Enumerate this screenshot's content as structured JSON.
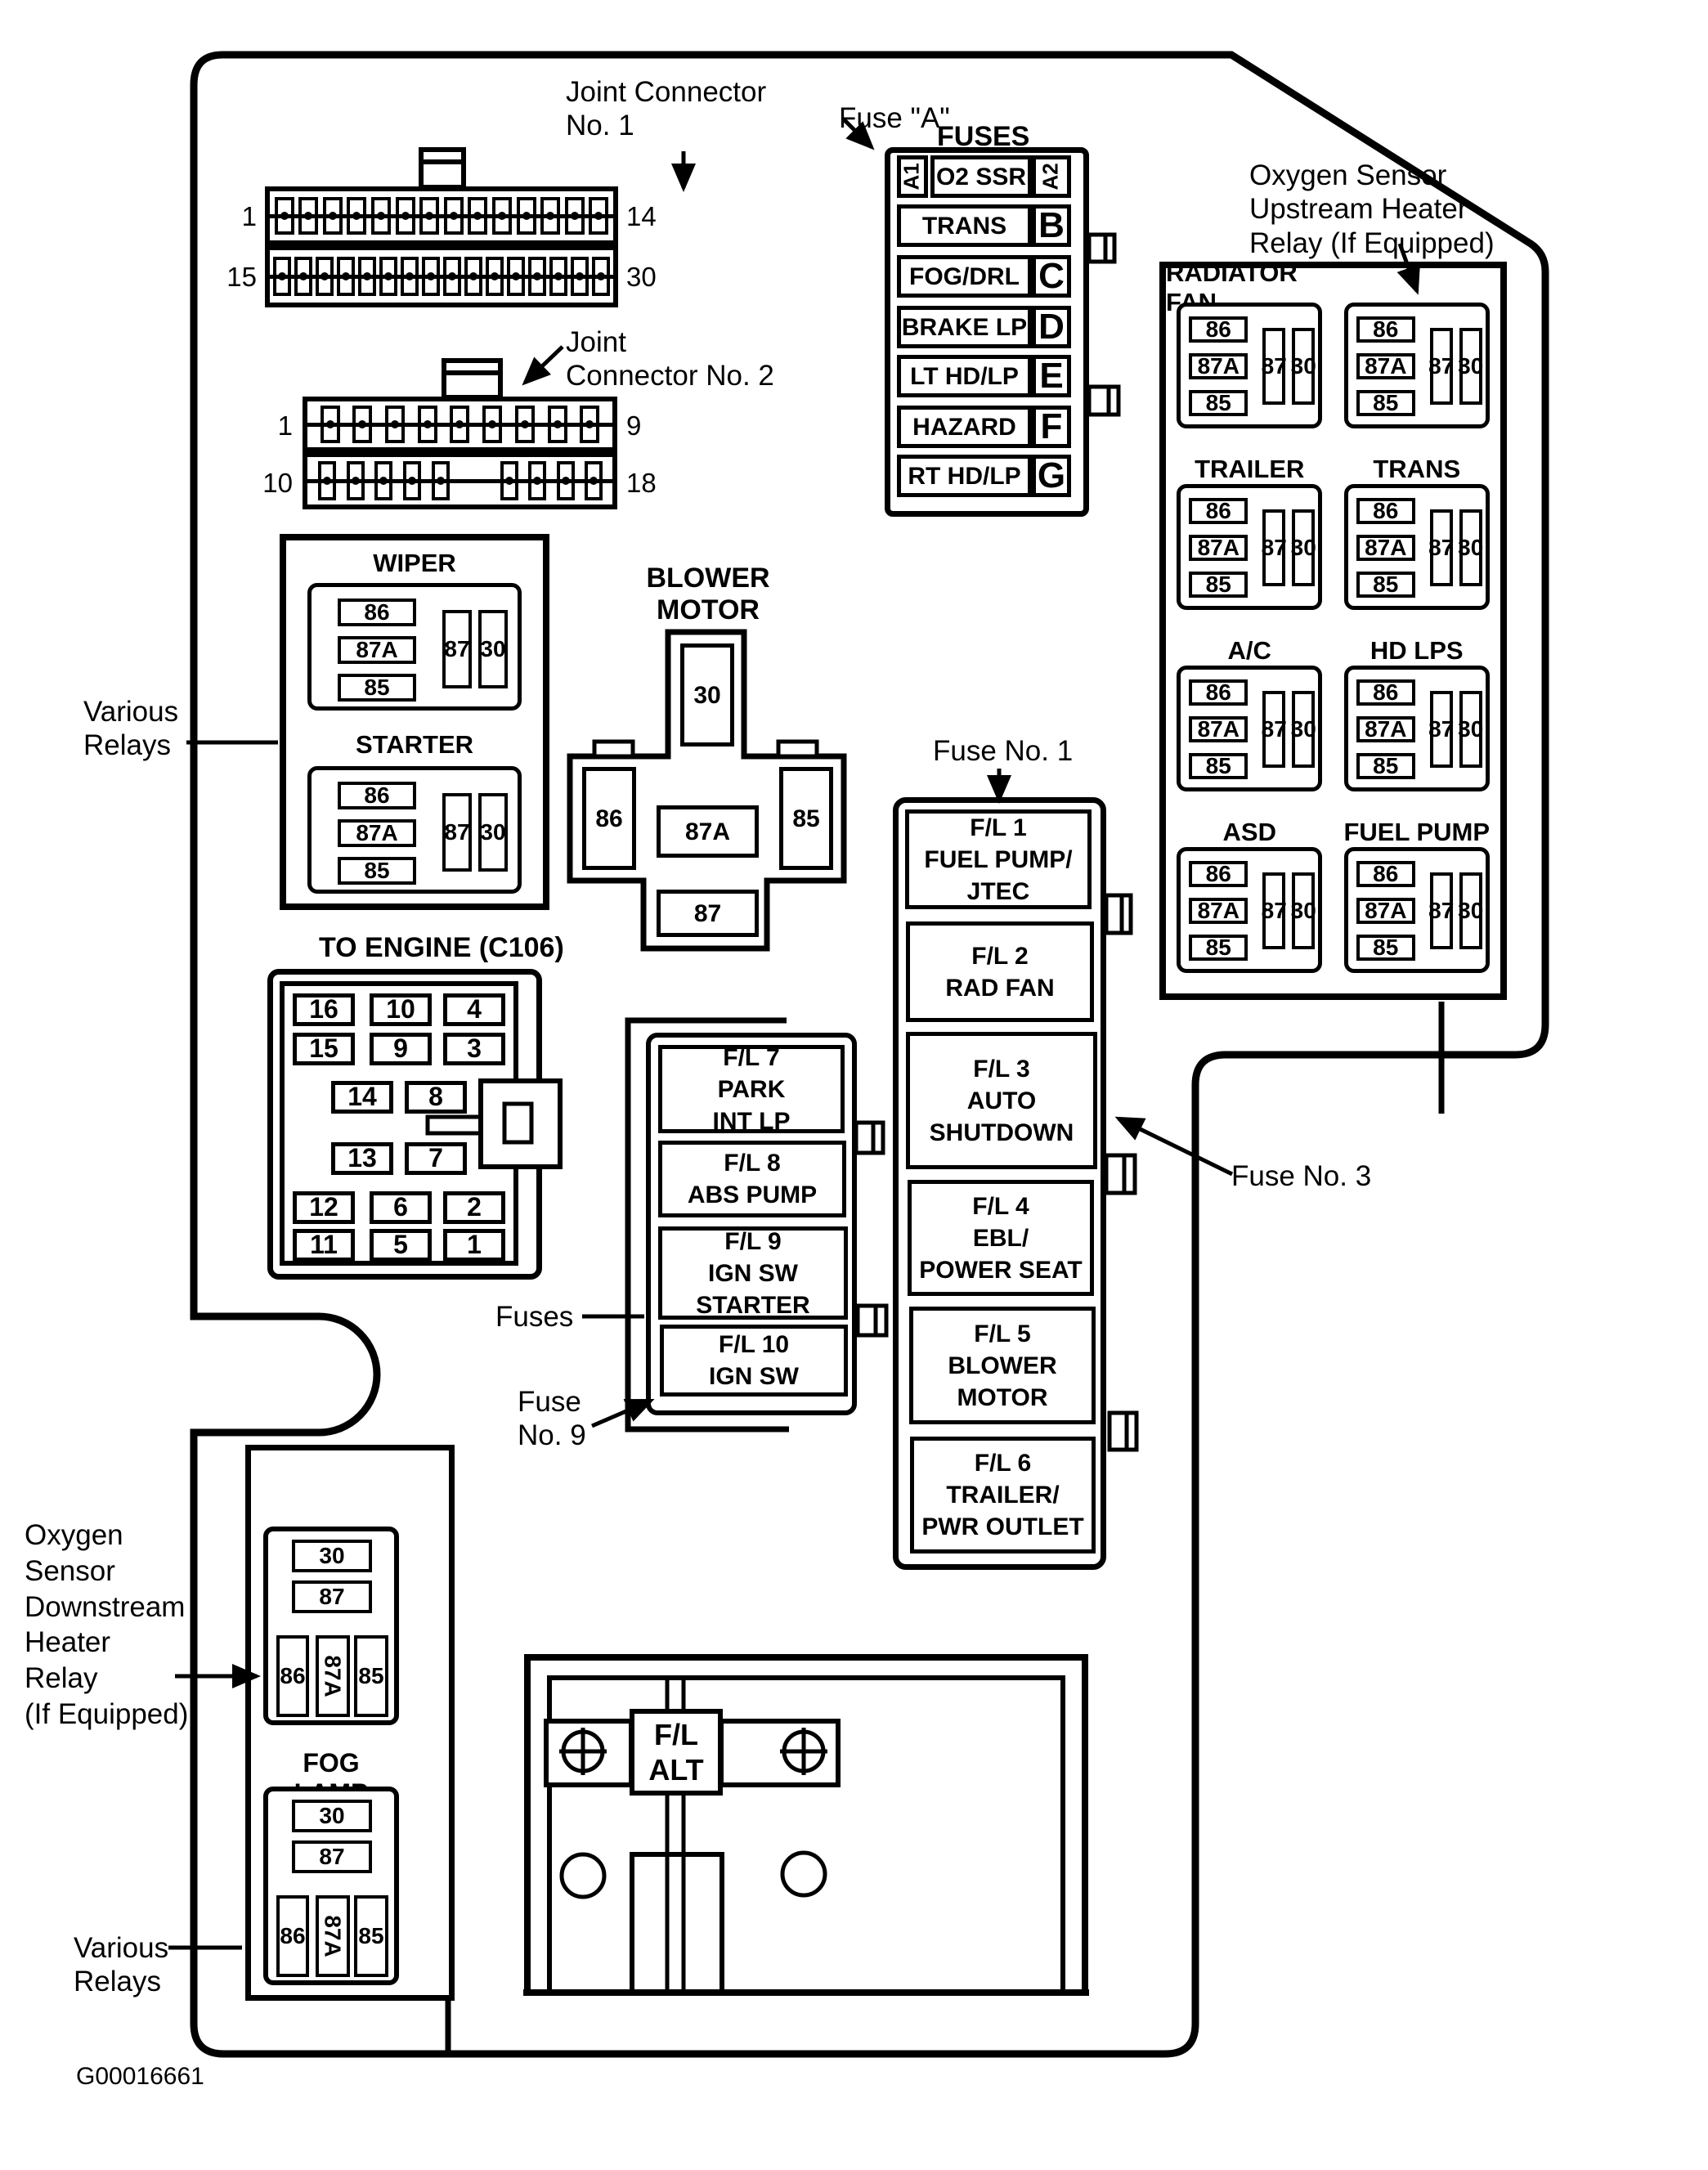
{
  "figure_code": "G00016661",
  "labels": {
    "joint_connector_1": "Joint Connector\nNo. 1",
    "fuse_a": "Fuse \"A\"",
    "fuses_title": "FUSES",
    "joint_connector_2": "Joint\nConnector No. 2",
    "o2_upstream": "Oxygen Sensor\nUpstream Heater\nRelay (If Equipped)",
    "various_relays_left": "Various\nRelays",
    "blower_motor": "BLOWER\nMOTOR",
    "engine_connector": "TO ENGINE (C106)",
    "fuse_no_1": "Fuse No. 1",
    "fuse_no_3": "Fuse No. 3",
    "fuses": "Fuses",
    "fuse_no_9": "Fuse\nNo. 9",
    "o2_downstream": "Oxygen\nSensor\nDownstream\nHeater\nRelay\n(If Equipped)",
    "fog_lamp": "FOG LAMP",
    "various_relays_bottom": "Various\nRelays",
    "wiper": "WIPER",
    "starter": "STARTER",
    "fl_alt": "F/L\nALT"
  },
  "connector1": {
    "row1_pins": 14,
    "row2_pins": 16,
    "pin_labels": {
      "row1_start": "1",
      "row1_end": "14",
      "row2_start": "15",
      "row2_end": "30"
    }
  },
  "connector2": {
    "row1_pins": 9,
    "row2_left_pins": 5,
    "row2_right_pins": 4,
    "pin_labels": {
      "row1_start": "1",
      "row1_end": "9",
      "row2_start": "10",
      "row2_end": "18"
    }
  },
  "fuse_column": {
    "rows": [
      {
        "left": "A1",
        "label": "O2 SSR",
        "right": "A2"
      },
      {
        "label": "TRANS",
        "letter": "B"
      },
      {
        "label": "FOG/DRL",
        "letter": "C"
      },
      {
        "label": "BRAKE LP",
        "letter": "D"
      },
      {
        "label": "LT HD/LP",
        "letter": "E"
      },
      {
        "label": "HAZARD",
        "letter": "F"
      },
      {
        "label": "RT HD/LP",
        "letter": "G"
      }
    ]
  },
  "relay_terminals": {
    "left": [
      "86",
      "87A",
      "85"
    ],
    "right": [
      "87",
      "30"
    ]
  },
  "relay_panel": [
    "RADIATOR FAN",
    "",
    "TRAILER",
    "TRANS",
    "A/C",
    "HD LPS",
    "ASD",
    "FUEL PUMP"
  ],
  "blower_terminals": {
    "top": "30",
    "left": "86",
    "center": "87A",
    "right": "85",
    "bottom": "87"
  },
  "engine_rows": [
    [
      "16",
      "10",
      "4"
    ],
    [
      "15",
      "9",
      "3"
    ],
    [
      "14",
      "8"
    ],
    [
      "13",
      "7"
    ],
    [
      "12",
      "6",
      "2"
    ],
    [
      "11",
      "5",
      "1"
    ]
  ],
  "fl_left": [
    "F/L 7\nPARK\nINT LP",
    "F/L 8\nABS PUMP",
    "F/L 9\nIGN SW\nSTARTER",
    "F/L 10\nIGN SW"
  ],
  "fl_right": [
    "F/L 1\nFUEL PUMP/\nJTEC",
    "F/L 2\nRAD FAN",
    "F/L 3\nAUTO\nSHUTDOWN",
    "F/L 4\nEBL/\nPOWER SEAT",
    "F/L 5\nBLOWER\nMOTOR",
    "F/L 6\nTRAILER/\nPWR OUTLET"
  ],
  "bottom_relays": {
    "top": [
      "30",
      "87"
    ],
    "bottom": [
      "86",
      "87A",
      "85"
    ]
  }
}
